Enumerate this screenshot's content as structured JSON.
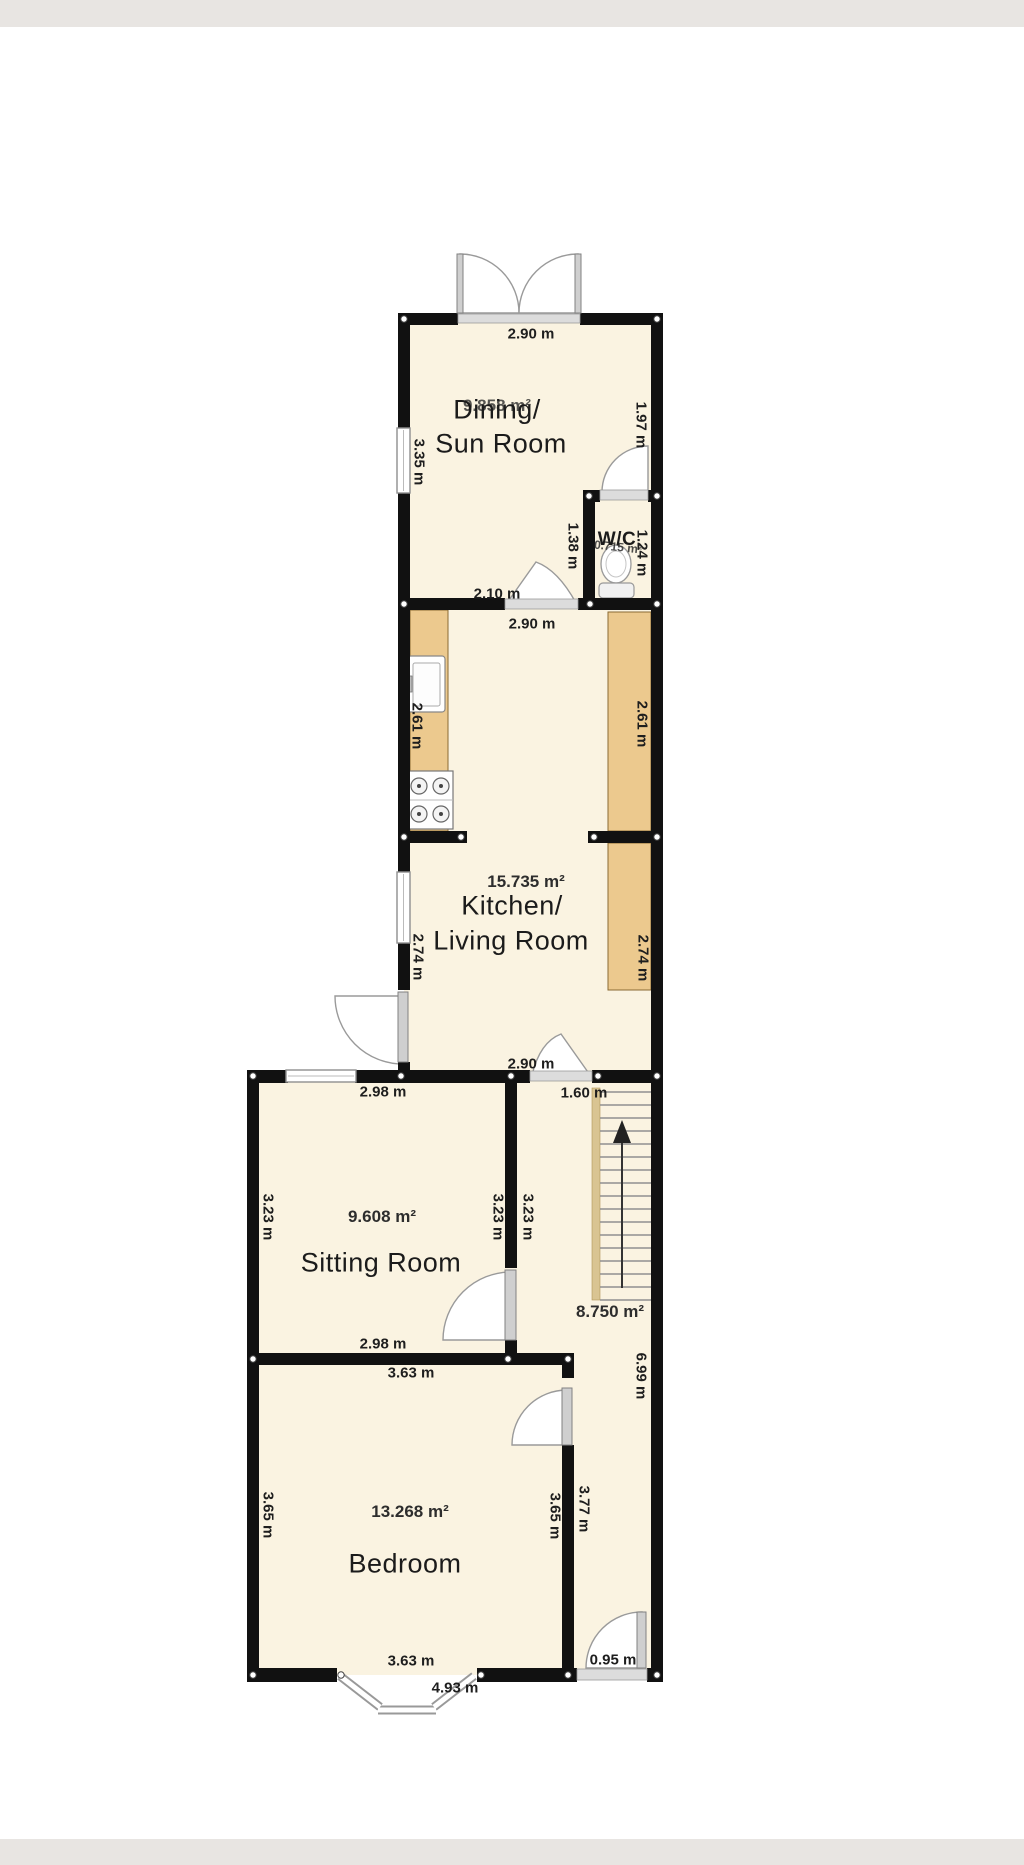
{
  "plan": {
    "rooms": {
      "dining": {
        "name_line1": "Dining/",
        "name_line2": "Sun Room",
        "area": "9.858 m²"
      },
      "wc": {
        "name": "W/C",
        "area": "0.715 m²"
      },
      "kitchen_living": {
        "name_line1": "Kitchen/",
        "name_line2": "Living Room",
        "area": "15.735 m²"
      },
      "sitting": {
        "name": "Sitting Room",
        "area": "9.608 m²"
      },
      "bedroom": {
        "name": "Bedroom",
        "area": "13.268 m²"
      },
      "hall_stairs": {
        "area": "8.750 m²"
      }
    },
    "dimensions": {
      "dining_width_top": "2.90 m",
      "dining_height_left": "3.35 m",
      "dining_height_right": "1.97 m",
      "wc_nook_height": "1.38 m",
      "wc_height": "1.24 m",
      "dining_width_bottom": "2.10 m",
      "kitchen_width_top": "2.90 m",
      "kitchen_upper_height_left": "2.61 m",
      "kitchen_upper_height_right": "2.61 m",
      "kitchen_lower_height_left": "2.74 m",
      "kitchen_lower_height_right": "2.74 m",
      "kitchen_width_bottom": "2.90 m",
      "sitting_width_top": "2.98 m",
      "hall_width_top": "1.60 m",
      "sitting_height_left": "3.23 m",
      "sitting_height_right": "3.23 m",
      "hall_height_upper": "3.23 m",
      "hall_height_lower": "6.99 m",
      "sitting_width_bottom": "2.98 m",
      "bedroom_width_top": "3.63 m",
      "bedroom_height_left": "3.65 m",
      "bedroom_height_right": "3.65 m",
      "hall_height_bedroom": "3.77 m",
      "bedroom_width_bottom": "3.63 m",
      "front_door_width": "0.95 m",
      "bay_window_width": "4.93 m"
    }
  }
}
